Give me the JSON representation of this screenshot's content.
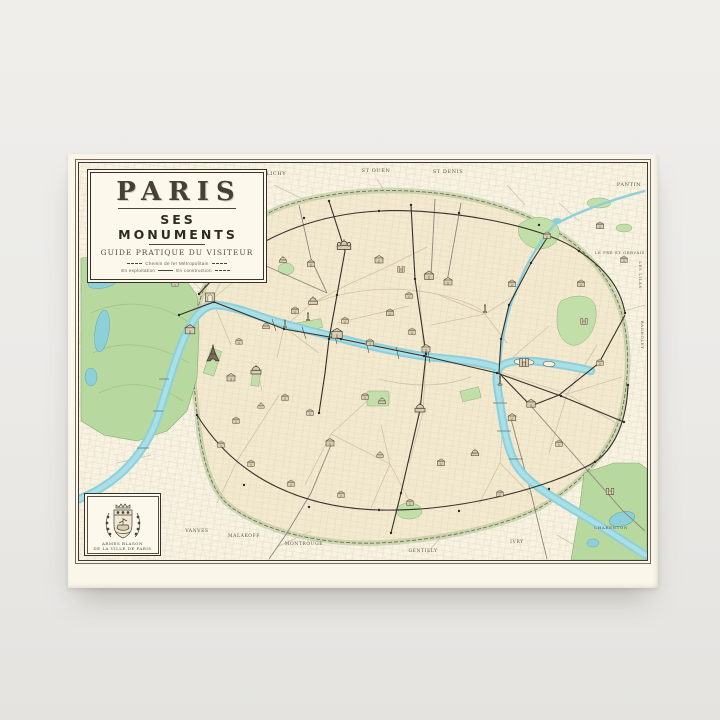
{
  "product": {
    "description": "Vintage Paris monuments map canvas print on gray studio background",
    "background_color": "#ECEBE8",
    "paper_color": "#FAF6EA"
  },
  "cartouche": {
    "title": "PARIS",
    "subtitle": "SES MONUMENTS",
    "tagline": "GUIDE PRATIQUE DU VISITEUR",
    "legend_metro": "Chemin de fer Métropolitain",
    "legend_open": "En exploitation",
    "legend_construction": "En construction"
  },
  "inset": {
    "emblem_icon": "paris-coat-of-arms",
    "caption_line1": "ARMES BLASON",
    "caption_line2": "DE LA VILLE DE PARIS"
  },
  "map": {
    "labels": {
      "levallois": "LEVALLOIS-PERRET",
      "clichy": "CLICHY",
      "st_ouen": "ST OUEN",
      "st_denis": "ST DENIS",
      "pantin": "PANTIN",
      "le_pre_st_gervais": "LE PRÉ ST GERVAIS",
      "les_lilas": "LES LILAS",
      "bagnolet": "BAGNOLET",
      "charenton": "CHARENTON",
      "ivry": "IVRY",
      "gentilly": "GENTILLY",
      "montrouge": "MONTROUGE",
      "malakoff": "MALAKOFF",
      "vanves": "VANVES"
    },
    "features": {
      "river": "seine-river",
      "canal": "canal-st-martin-ourcq",
      "woods_west": "bois-de-boulogne",
      "woods_east": "bois-de-vincennes"
    },
    "colors": {
      "water": "#8ED0DA",
      "park": "#B7D99F",
      "built": "#F3E9CF",
      "ink": "#433C31",
      "label": "#5F5749"
    }
  }
}
